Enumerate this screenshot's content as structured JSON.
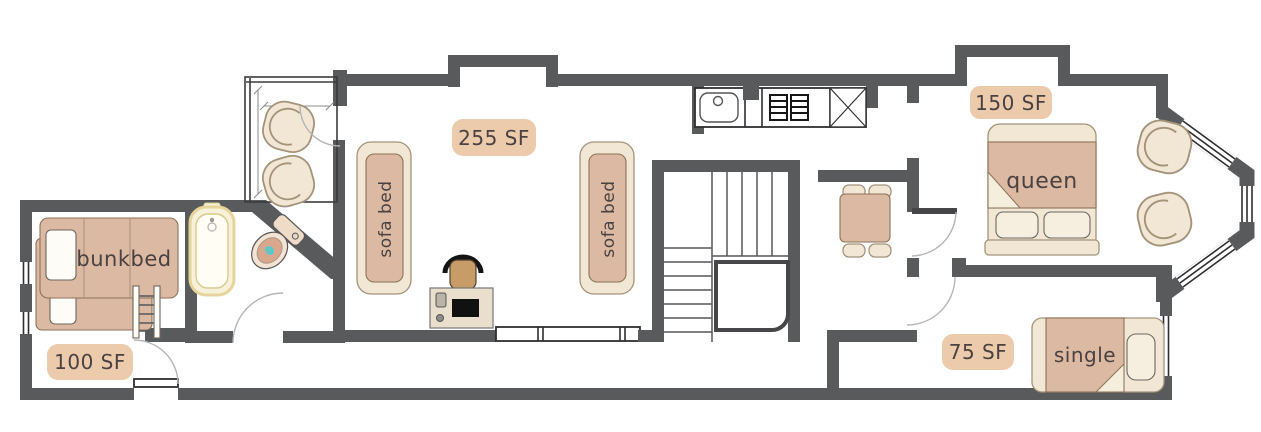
{
  "colors": {
    "wall": "#595a5c",
    "ink": "#4a4140",
    "tan": "#dcb9a2",
    "tanline": "#8a7258",
    "cream": "#f1e7d4",
    "creamline": "#a4937b",
    "badge": "#eccaac",
    "teal": "#5ec8c9",
    "tub": "#f8f1da",
    "tubline": "#e5d49b",
    "desk": "#eadfcc",
    "seat": "#c79c66",
    "arc": "#b5b5b5",
    "glaze": "#2e2e30",
    "tread": "#57575a"
  },
  "rooms": [
    {
      "id": "living-room",
      "area_label": "255 SF",
      "furniture": [
        {
          "type": "sofa-bed",
          "label": "sofa bed"
        },
        {
          "type": "sofa-bed",
          "label": "sofa bed"
        },
        {
          "type": "desk"
        },
        {
          "type": "office-chair"
        }
      ]
    },
    {
      "id": "kitchen",
      "furniture": [
        {
          "type": "sink"
        },
        {
          "type": "stove"
        },
        {
          "type": "cabinet-x"
        }
      ]
    },
    {
      "id": "entry-porch",
      "furniture": [
        {
          "type": "armchair"
        },
        {
          "type": "armchair"
        }
      ]
    },
    {
      "id": "bathroom",
      "furniture": [
        {
          "type": "bathtub"
        },
        {
          "type": "toilet"
        }
      ]
    },
    {
      "id": "bunk-room",
      "area_label": "100 SF",
      "furniture": [
        {
          "type": "bunk-bed",
          "label": "bunkbed"
        }
      ]
    },
    {
      "id": "dining-nook",
      "furniture": [
        {
          "type": "dining-table"
        },
        {
          "type": "dining-chair"
        },
        {
          "type": "dining-chair"
        },
        {
          "type": "dining-chair"
        },
        {
          "type": "dining-chair"
        }
      ]
    },
    {
      "id": "staircase"
    },
    {
      "id": "queen-bedroom",
      "area_label": "150 SF",
      "furniture": [
        {
          "type": "queen-bed",
          "label": "queen"
        },
        {
          "type": "armchair"
        },
        {
          "type": "armchair"
        }
      ]
    },
    {
      "id": "single-bedroom",
      "area_label": "75 SF",
      "furniture": [
        {
          "type": "single-bed",
          "label": "single"
        }
      ]
    }
  ]
}
